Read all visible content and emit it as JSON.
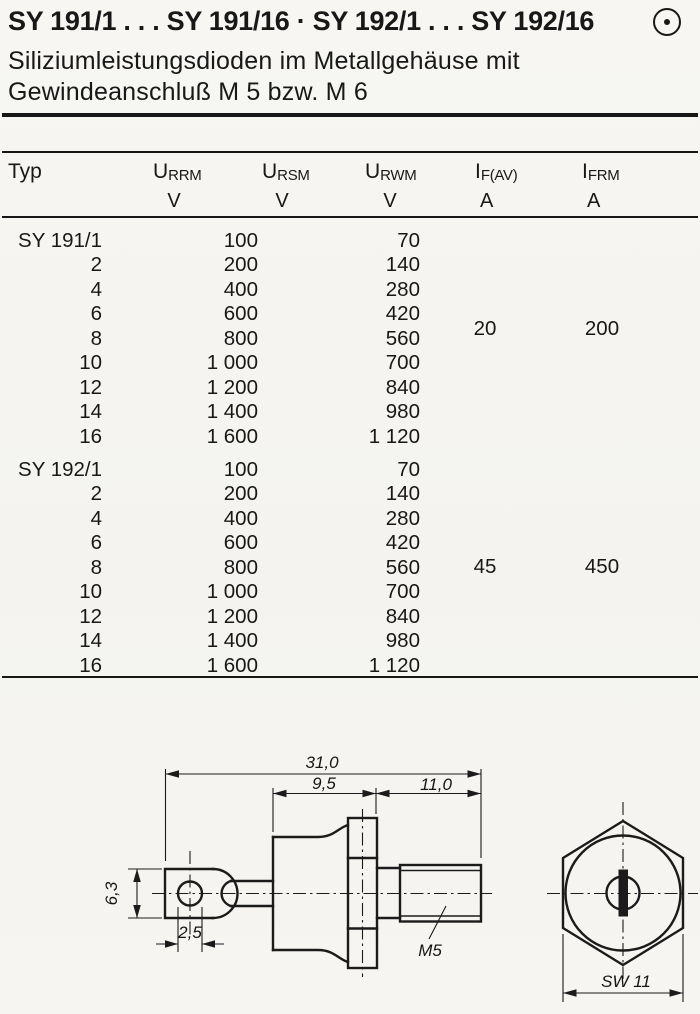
{
  "header": {
    "title": "SY 191/1 . . . SY 191/16 · SY 192/1 . . . SY 192/16",
    "subtitle_lines": [
      "Siliziumleistungsdioden im Metallgehäuse mit",
      "Gewindeanschluß M 5 bzw. M 6"
    ],
    "corner_icon": "circled-dot"
  },
  "table": {
    "typ_label": "Typ",
    "columns": [
      {
        "base": "U",
        "sub": "RRM",
        "unit": "V"
      },
      {
        "base": "U",
        "sub": "RSM",
        "unit": "V"
      },
      {
        "base": "U",
        "sub": "RWM",
        "unit": "V"
      },
      {
        "base": "I",
        "sub": "F(AV)",
        "unit": "A"
      },
      {
        "base": "I",
        "sub": "FRM",
        "unit": "A"
      }
    ],
    "groups": [
      {
        "name": "SY 191",
        "rows": [
          [
            "SY 191/1",
            "100",
            "70"
          ],
          [
            "2",
            "200",
            "140"
          ],
          [
            "4",
            "400",
            "280"
          ],
          [
            "6",
            "600",
            "420"
          ],
          [
            "8",
            "800",
            "560"
          ],
          [
            "10",
            "1 000",
            "700"
          ],
          [
            "12",
            "1 200",
            "840"
          ],
          [
            "14",
            "1 400",
            "980"
          ],
          [
            "16",
            "1 600",
            "1 120"
          ]
        ],
        "if_av": "20",
        "ifrm": "200"
      },
      {
        "name": "SY 192",
        "rows": [
          [
            "SY 192/1",
            "100",
            "70"
          ],
          [
            "2",
            "200",
            "140"
          ],
          [
            "4",
            "400",
            "280"
          ],
          [
            "6",
            "600",
            "420"
          ],
          [
            "8",
            "800",
            "560"
          ],
          [
            "10",
            "1 000",
            "700"
          ],
          [
            "12",
            "1 200",
            "840"
          ],
          [
            "14",
            "1 400",
            "980"
          ],
          [
            "16",
            "1 600",
            "1 120"
          ]
        ],
        "if_av": "45",
        "ifrm": "450"
      }
    ]
  },
  "drawing": {
    "side_view": {
      "dim_total_length": "31,0",
      "dim_body_length": "9,5",
      "dim_stud_length": "11,0",
      "dim_lug_height": "6,3",
      "dim_hole_diameter": "2,5",
      "thread_label": "M5"
    },
    "front_view": {
      "wrench_size": "SW 11"
    }
  }
}
